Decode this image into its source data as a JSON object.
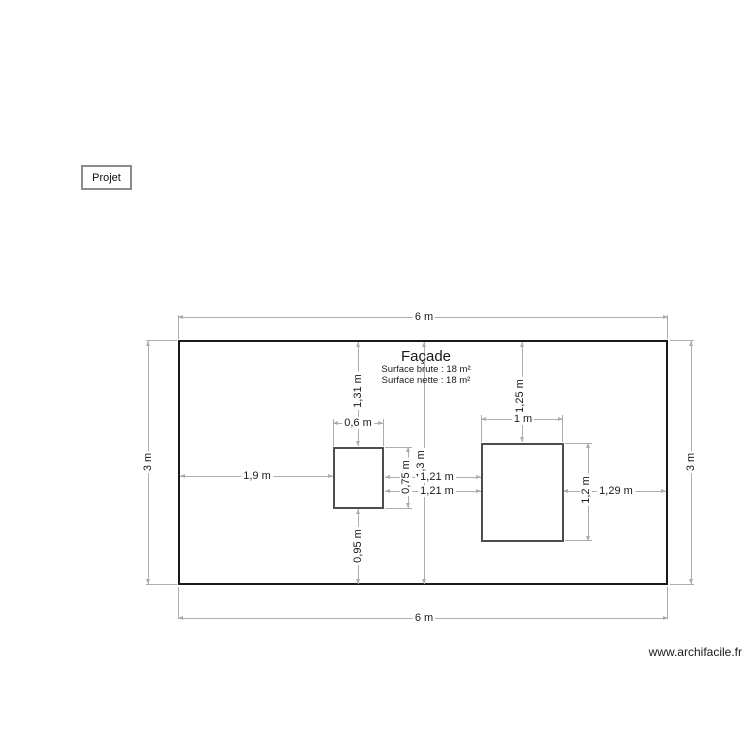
{
  "project": {
    "label": "Projet"
  },
  "watermark": "www.archifacile.fr",
  "drawing": {
    "title": "Façade",
    "surface_brute": "Surface brute : 18 m²",
    "surface_nette": "Surface nette : 18 m²",
    "wall": {
      "width_label_top": "6 m",
      "width_label_bottom": "6 m",
      "height_label_left": "3 m",
      "height_label_right": "3 m"
    },
    "window_small": {
      "width": "0,6 m",
      "height": "0,75 m",
      "offset_left": "1,9 m",
      "offset_top": "1,31 m",
      "offset_bottom": "0,95 m"
    },
    "window_large": {
      "width": "1 m",
      "height": "1,2 m",
      "offset_top": "1,25 m",
      "offset_right": "1,29 m"
    },
    "between": {
      "gap_upper": "1,21 m",
      "gap_lower": "1,21 m",
      "center_line": "1,3 m"
    },
    "colors": {
      "wall_border": "#1a1a1a",
      "window_border": "#4d4d4d",
      "dimension_line": "#adadad",
      "text": "#1a1a1a",
      "background": "#ffffff"
    }
  }
}
